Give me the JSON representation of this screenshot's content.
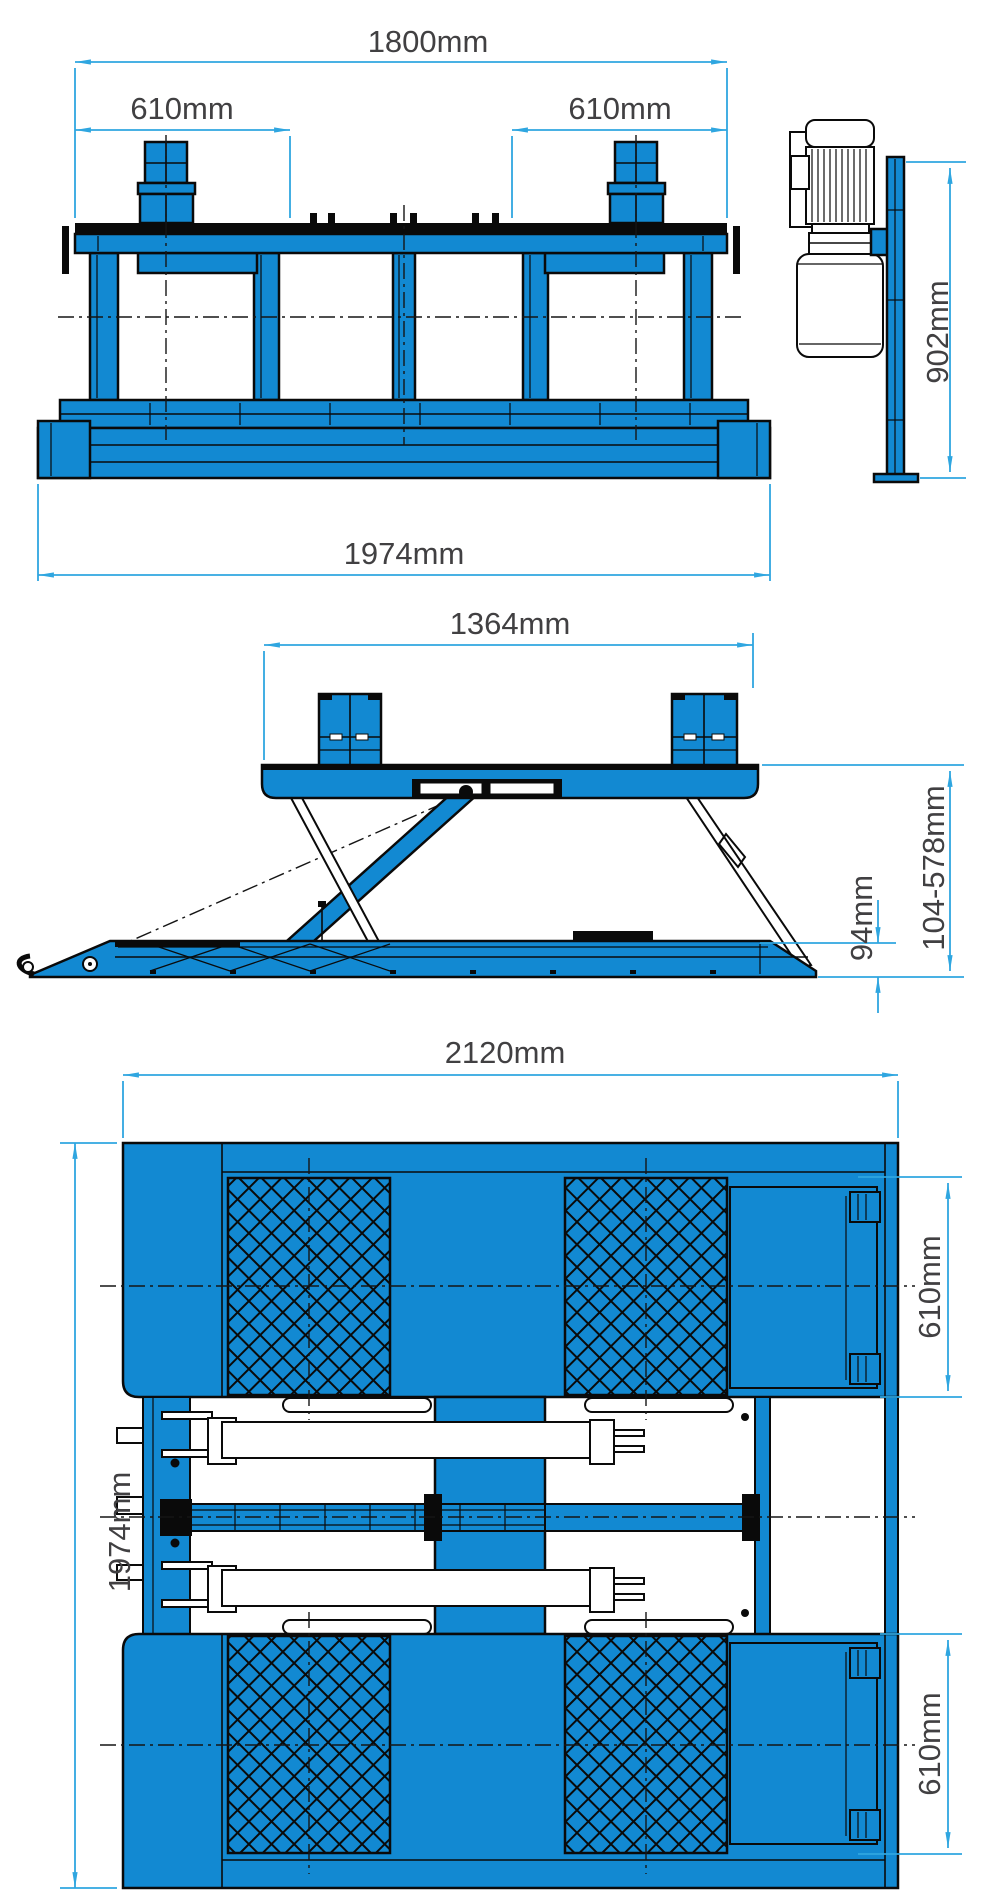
{
  "drawing_type": "scissor-lift-dimension-drawing",
  "colors": {
    "part_blue": "#1289d2",
    "dimension_blue": "#2fa6e0",
    "outline_black": "#0a0a0a",
    "label_gray": "#414042"
  },
  "views": {
    "front_lowered": {
      "dim_overall_width": "1800mm",
      "dim_left_platform_width": "610mm",
      "dim_right_platform_width": "610mm",
      "dim_base_frame_width": "1974mm"
    },
    "power_unit_side": {
      "dim_unit_height": "902mm"
    },
    "side_raised": {
      "dim_platform_length": "1364mm",
      "dim_lifting_height_range": "104-578mm",
      "dim_lowered_height": "94mm"
    },
    "plan_top": {
      "dim_overall_length": "2120mm",
      "dim_overall_width": "1974mm",
      "dim_upper_tread_width": "610mm",
      "dim_lower_tread_width": "610mm"
    }
  }
}
